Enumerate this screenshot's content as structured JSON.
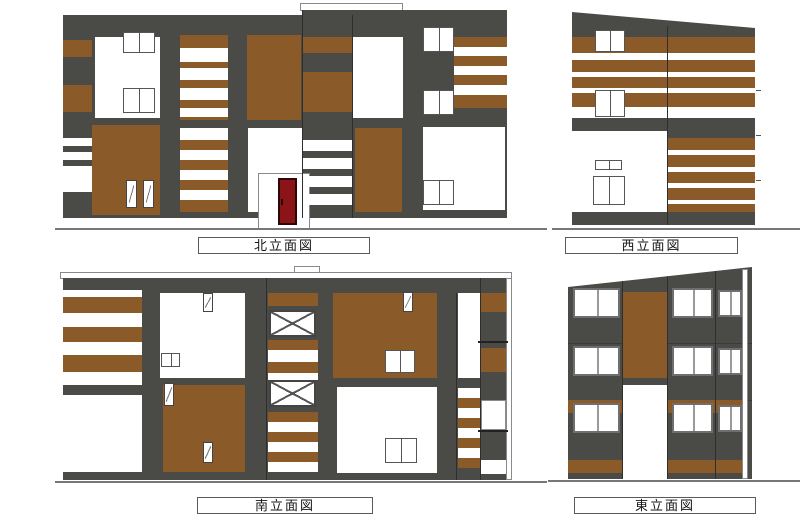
{
  "elevations": [
    {
      "id": "north",
      "label": "北立面図"
    },
    {
      "id": "west",
      "label": "西立面図"
    },
    {
      "id": "south",
      "label": "南立面図"
    },
    {
      "id": "east",
      "label": "東立面図"
    }
  ],
  "colors": {
    "wall": "#4a4a47",
    "accent": "#8a5a28",
    "door": "#8a1418",
    "paper": "#ffffff"
  }
}
